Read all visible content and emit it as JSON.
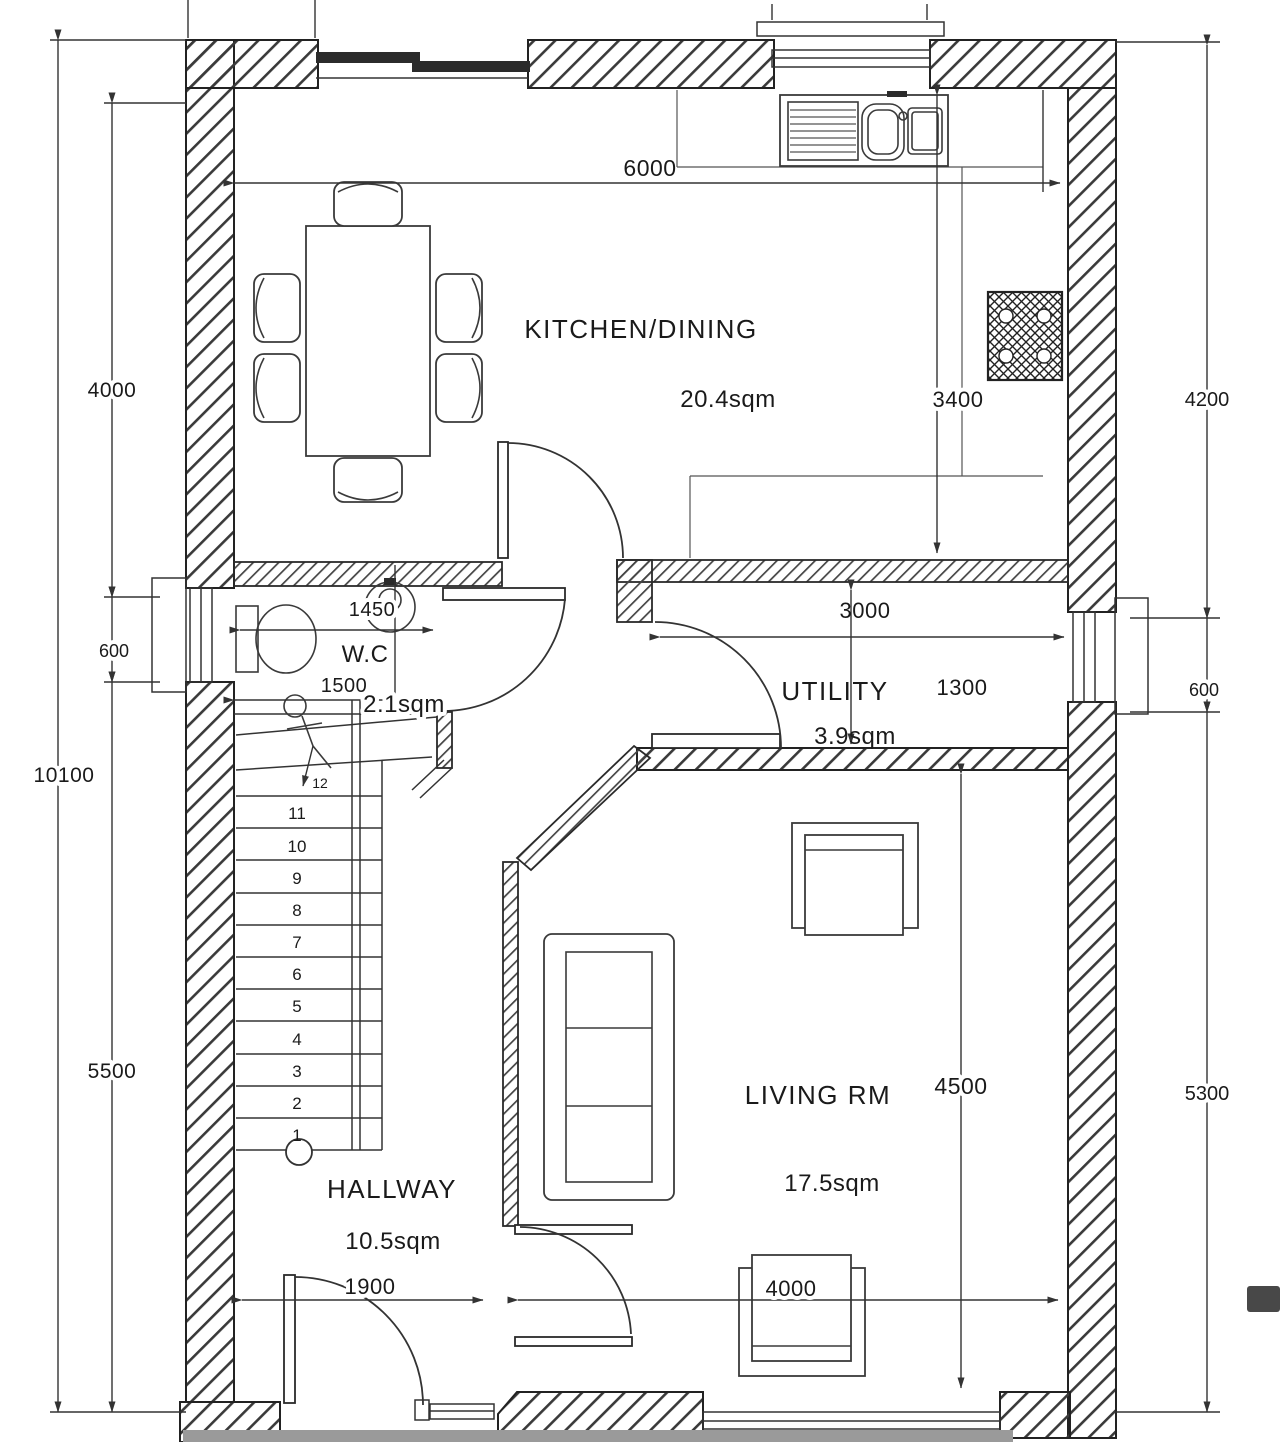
{
  "plan": {
    "type": "ground-floor-plan",
    "colors": {
      "line": "#2a2a2a",
      "paper": "#ffffff",
      "scan_band": "#9a9a9a"
    }
  },
  "rooms": {
    "kitchen_dining": {
      "label": "KITCHEN/DINING",
      "area": "20.4sqm"
    },
    "wc": {
      "label": "W.C",
      "area": "2.1sqm"
    },
    "utility": {
      "label": "UTILITY",
      "area": "3.9sqm"
    },
    "living": {
      "label": "LIVING RM",
      "area": "17.5sqm"
    },
    "hallway": {
      "label": "HALLWAY",
      "area": "10.5sqm"
    }
  },
  "dimensions": {
    "overall_height": "10100",
    "left_upper": "4000",
    "left_window": "600",
    "left_lower": "5500",
    "kitchen_width": "6000",
    "kitchen_depth": "3400",
    "right_upper": "4200",
    "right_window": "600",
    "right_lower": "5300",
    "wc_width": "1450",
    "wc_length": "1500",
    "utility_width": "3000",
    "utility_depth": "1300",
    "living_depth": "4500",
    "living_width": "4000",
    "hall_door_width": "1900"
  },
  "stairs": {
    "steps": [
      "1",
      "2",
      "3",
      "4",
      "5",
      "6",
      "7",
      "8",
      "9",
      "10",
      "11",
      "12"
    ]
  }
}
